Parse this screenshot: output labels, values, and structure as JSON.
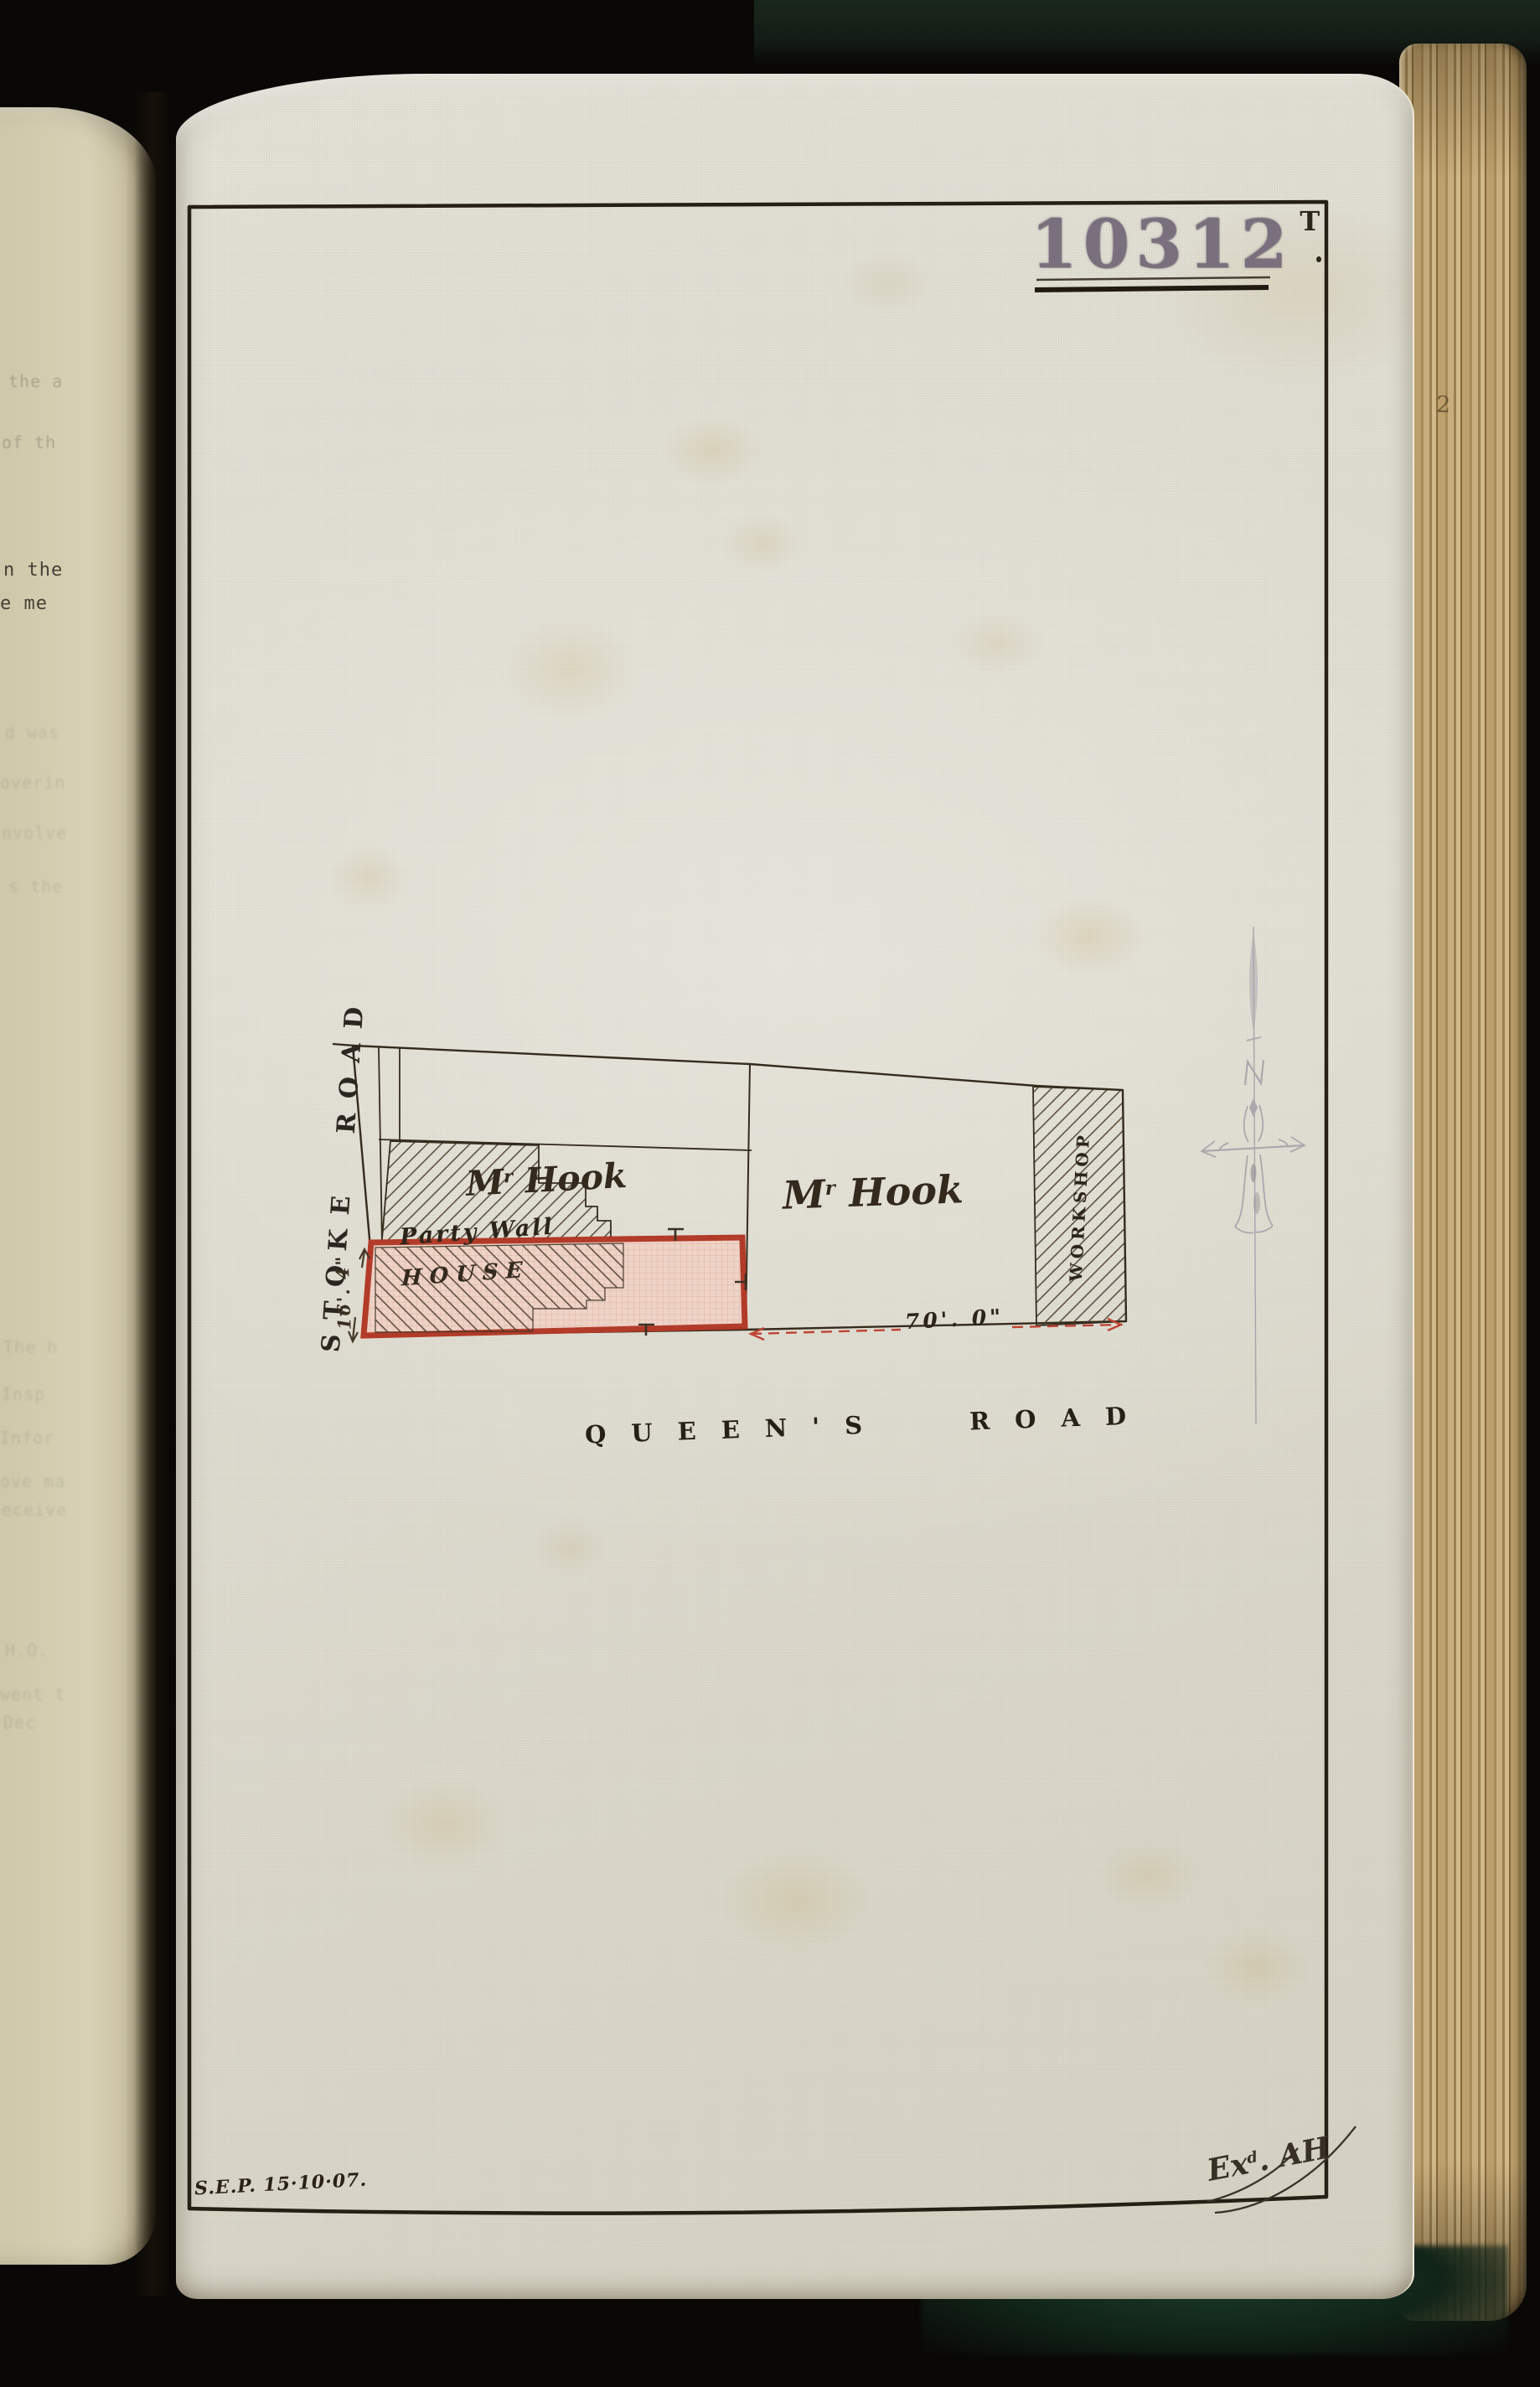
{
  "stamp": {
    "number": "10312",
    "superscript": "T"
  },
  "plan": {
    "road_left": "STOKE ROAD",
    "road_bottom": "QUEEN'S ROAD",
    "owner_left": {
      "prefix": "M",
      "sup": "r",
      "rest": " Hook"
    },
    "owner_right": {
      "prefix": "M",
      "sup": "r",
      "rest": " Hook"
    },
    "party_wall_label": "Party Wall",
    "house_label": "HOUSE",
    "workshop_label": "WORKSHOP",
    "dim_queens_frontage": "70'. 0\"",
    "dim_stoke_frontage": "16'. 4\""
  },
  "annotations": {
    "surveyor_note": "S.E.P. 15·10·07.",
    "examined": {
      "prefix": "Ex",
      "sup": "d",
      "rest": ". AH"
    },
    "page_edge_number": "2"
  },
  "left_page_fragments": [
    "the a",
    "of th",
    "n the",
    "e me",
    "d was",
    "overin",
    "nvolve",
    "s the",
    "The h",
    "Insp",
    "Infor",
    "ove ma",
    "eceive",
    "H.O.",
    "went t",
    "Dec"
  ]
}
